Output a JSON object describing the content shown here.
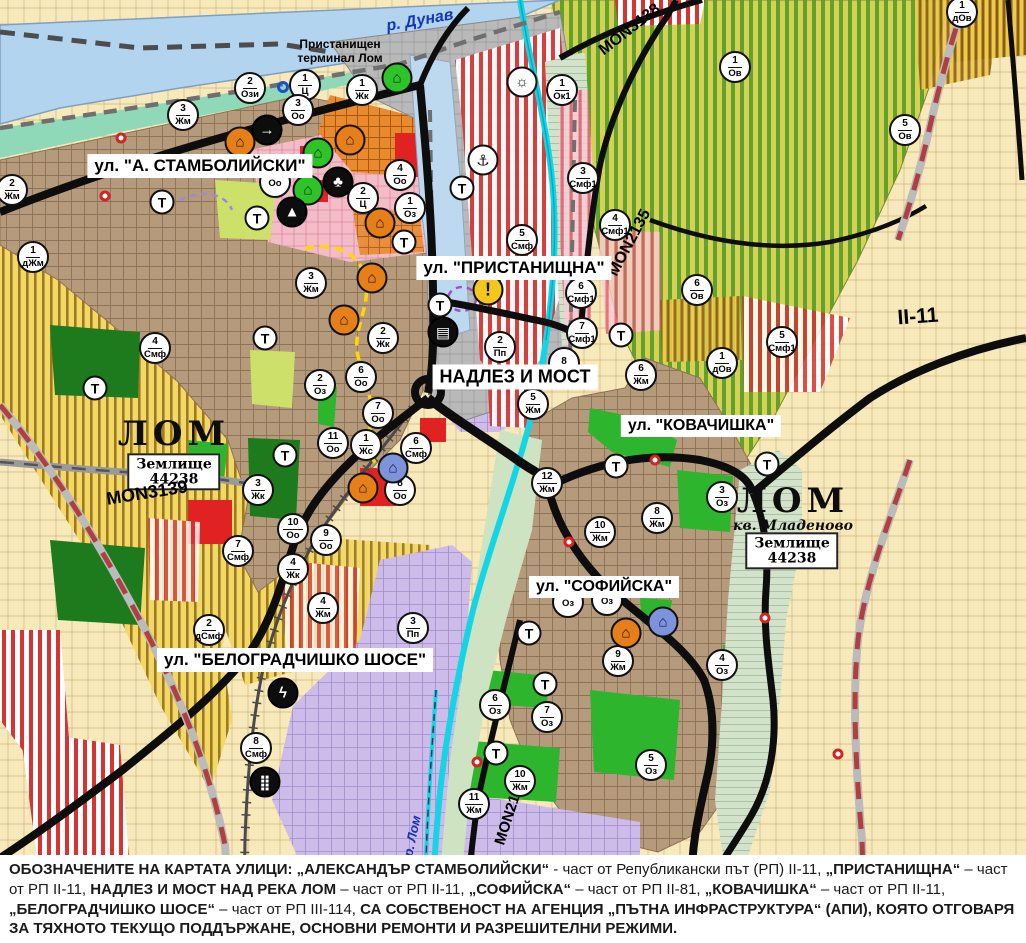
{
  "palette": {
    "water": "#b3d4ee",
    "road": "#0d0d0d",
    "river": "#12d6e6",
    "boundary_red": "#b04040",
    "field_yellow": "#f3d867",
    "orchard_green": "#5fa32c",
    "urban_brown": "#b59b7c",
    "industrial_lavender": "#cdbcea",
    "port_grey": "#b9b9b9",
    "zone_red_stripe": "#d63333"
  },
  "map": {
    "street_labels": [
      {
        "text": "ул. \"А. СТАМБОЛИЙСКИ\"",
        "x": 200,
        "y": 166,
        "fs": 17
      },
      {
        "text": "ул. \"ПРИСТАНИЩНА\"",
        "x": 514,
        "y": 268,
        "fs": 17
      },
      {
        "text": "НАДЛЕЗ И МОСТ",
        "x": 515,
        "y": 377,
        "fs": 18
      },
      {
        "text": "ул. \"КОВАЧИШКА\"",
        "x": 701,
        "y": 426,
        "fs": 16
      },
      {
        "text": "ул. \"СОФИЙСКА\"",
        "x": 604,
        "y": 587,
        "fs": 16
      },
      {
        "text": "ул. \"БЕЛОГРАДЧИШКО ШОСЕ\"",
        "x": 295,
        "y": 660,
        "fs": 17
      }
    ],
    "city_labels": [
      {
        "text": "ЛОМ",
        "x": 174,
        "y": 434
      },
      {
        "text": "ЛОМ",
        "x": 793,
        "y": 501
      }
    ],
    "suburb_label": {
      "text": "кв. Младеново",
      "x": 793,
      "y": 526
    },
    "land_unit_boxes": [
      {
        "text": "Землище\n44238",
        "x": 174,
        "y": 472
      },
      {
        "text": "Землище\n44238",
        "x": 792,
        "y": 551
      }
    ],
    "road_labels": [
      {
        "text": "MON3139",
        "x": 147,
        "y": 493,
        "rot": -9,
        "fs": 18
      },
      {
        "text": "MON3138",
        "x": 630,
        "y": 30,
        "rot": -38,
        "fs": 16
      },
      {
        "text": "MON2135",
        "x": 630,
        "y": 243,
        "rot": -62,
        "fs": 16
      },
      {
        "text": "MON2136",
        "x": 510,
        "y": 812,
        "rot": -72,
        "fs": 15
      },
      {
        "text": "II-11",
        "x": 918,
        "y": 317,
        "rot": -4,
        "fs": 21
      }
    ],
    "river_labels": [
      {
        "text": "р. Дунав",
        "x": 420,
        "y": 21,
        "rot": -10,
        "fs": 16
      },
      {
        "text": "р. Лом",
        "x": 412,
        "y": 836,
        "rot": -78,
        "fs": 13
      }
    ],
    "port_label": {
      "text": "Пристанищен\nтерминал Лом",
      "x": 340,
      "y": 52
    }
  },
  "markers": {
    "t_label": "Т",
    "zone": [
      {
        "x": 250,
        "y": 88,
        "n": "2",
        "z": "Ози"
      },
      {
        "x": 305,
        "y": 85,
        "n": "1",
        "z": "Ц"
      },
      {
        "x": 362,
        "y": 90,
        "n": "1",
        "z": "Жк"
      },
      {
        "x": 562,
        "y": 90,
        "n": "1",
        "z": "Ок1"
      },
      {
        "x": 298,
        "y": 110,
        "n": "3",
        "z": "Оо"
      },
      {
        "x": 183,
        "y": 115,
        "n": "3",
        "z": "Жм"
      },
      {
        "x": 12,
        "y": 190,
        "n": "2",
        "z": "Жм"
      },
      {
        "x": 33,
        "y": 257,
        "n": "1",
        "z": "дЖм"
      },
      {
        "x": 400,
        "y": 175,
        "n": "4",
        "z": "Оо"
      },
      {
        "x": 275,
        "y": 182,
        "n": "",
        "z": "Оо"
      },
      {
        "x": 363,
        "y": 198,
        "n": "2",
        "z": "Ц"
      },
      {
        "x": 410,
        "y": 208,
        "n": "1",
        "z": "Оз"
      },
      {
        "x": 522,
        "y": 240,
        "n": "5",
        "z": "Смф"
      },
      {
        "x": 583,
        "y": 178,
        "n": "3",
        "z": "Смф1"
      },
      {
        "x": 615,
        "y": 225,
        "n": "4",
        "z": "Смф1"
      },
      {
        "x": 581,
        "y": 293,
        "n": "6",
        "z": "Смф1"
      },
      {
        "x": 582,
        "y": 333,
        "n": "7",
        "z": "Смф1"
      },
      {
        "x": 697,
        "y": 290,
        "n": "6",
        "z": "Ов"
      },
      {
        "x": 782,
        "y": 342,
        "n": "5",
        "z": "Смф1"
      },
      {
        "x": 722,
        "y": 363,
        "n": "1",
        "z": "дОв"
      },
      {
        "x": 735,
        "y": 67,
        "n": "1",
        "z": "Ов"
      },
      {
        "x": 905,
        "y": 130,
        "n": "5",
        "z": "Ов"
      },
      {
        "x": 962,
        "y": 12,
        "n": "1",
        "z": "дОв"
      },
      {
        "x": 311,
        "y": 283,
        "n": "3",
        "z": "Жм"
      },
      {
        "x": 383,
        "y": 338,
        "n": "2",
        "z": "Жк"
      },
      {
        "x": 320,
        "y": 385,
        "n": "2",
        "z": "Оз"
      },
      {
        "x": 361,
        "y": 377,
        "n": "6",
        "z": "Оо"
      },
      {
        "x": 378,
        "y": 413,
        "n": "7",
        "z": "Оо"
      },
      {
        "x": 333,
        "y": 443,
        "n": "11",
        "z": "Оо"
      },
      {
        "x": 366,
        "y": 445,
        "n": "1",
        "z": "Жс"
      },
      {
        "x": 416,
        "y": 448,
        "n": "6",
        "z": "Смф"
      },
      {
        "x": 400,
        "y": 490,
        "n": "8",
        "z": "Оо"
      },
      {
        "x": 258,
        "y": 490,
        "n": "3",
        "z": "Жк"
      },
      {
        "x": 155,
        "y": 348,
        "n": "4",
        "z": "Смф"
      },
      {
        "x": 293,
        "y": 529,
        "n": "10",
        "z": "Оо"
      },
      {
        "x": 326,
        "y": 540,
        "n": "9",
        "z": "Оо"
      },
      {
        "x": 293,
        "y": 569,
        "n": "4",
        "z": "Жк"
      },
      {
        "x": 238,
        "y": 551,
        "n": "7",
        "z": "Смф"
      },
      {
        "x": 323,
        "y": 608,
        "n": "4",
        "z": "Жм"
      },
      {
        "x": 209,
        "y": 630,
        "n": "2",
        "z": "дСмф"
      },
      {
        "x": 413,
        "y": 628,
        "n": "3",
        "z": "Пп"
      },
      {
        "x": 256,
        "y": 748,
        "n": "8",
        "z": "Смф"
      },
      {
        "x": 500,
        "y": 347,
        "n": "2",
        "z": "Пп"
      },
      {
        "x": 564,
        "y": 363,
        "n": "8",
        "z": ""
      },
      {
        "x": 533,
        "y": 404,
        "n": "5",
        "z": "Жм"
      },
      {
        "x": 641,
        "y": 375,
        "n": "6",
        "z": "Жм"
      },
      {
        "x": 600,
        "y": 532,
        "n": "10",
        "z": "Жм"
      },
      {
        "x": 547,
        "y": 483,
        "n": "12",
        "z": "Жм"
      },
      {
        "x": 657,
        "y": 518,
        "n": "8",
        "z": "Жм"
      },
      {
        "x": 722,
        "y": 497,
        "n": "3",
        "z": "Оз"
      },
      {
        "x": 568,
        "y": 602,
        "n": "",
        "z": "Оз"
      },
      {
        "x": 607,
        "y": 600,
        "n": "",
        "z": "Оз"
      },
      {
        "x": 618,
        "y": 661,
        "n": "9",
        "z": "Жм"
      },
      {
        "x": 722,
        "y": 665,
        "n": "4",
        "z": "Оз"
      },
      {
        "x": 495,
        "y": 705,
        "n": "6",
        "z": "Оз"
      },
      {
        "x": 547,
        "y": 717,
        "n": "7",
        "z": "Оз"
      },
      {
        "x": 651,
        "y": 765,
        "n": "5",
        "z": "Оз"
      },
      {
        "x": 520,
        "y": 781,
        "n": "10",
        "z": "Жм"
      },
      {
        "x": 474,
        "y": 804,
        "n": "11",
        "z": "Жм"
      }
    ],
    "transport": [
      {
        "x": 162,
        "y": 202
      },
      {
        "x": 257,
        "y": 218
      },
      {
        "x": 265,
        "y": 338
      },
      {
        "x": 95,
        "y": 388
      },
      {
        "x": 285,
        "y": 455
      },
      {
        "x": 404,
        "y": 242
      },
      {
        "x": 440,
        "y": 305
      },
      {
        "x": 462,
        "y": 188
      },
      {
        "x": 621,
        "y": 335
      },
      {
        "x": 616,
        "y": 466
      },
      {
        "x": 529,
        "y": 633
      },
      {
        "x": 545,
        "y": 684
      },
      {
        "x": 496,
        "y": 753
      },
      {
        "x": 767,
        "y": 464
      }
    ],
    "icon_glyphs": {
      "monument": "⌂",
      "sun": "☼",
      "anchor": "⚓",
      "people": "♣",
      "peak": "▲",
      "arrow": "→",
      "truck": "▤",
      "lightning": "ϟ",
      "dots": "⣿",
      "warning": "!"
    },
    "icons": [
      {
        "x": 397,
        "y": 78,
        "type": "monument",
        "c": "green"
      },
      {
        "x": 318,
        "y": 153,
        "type": "monument",
        "c": "green"
      },
      {
        "x": 308,
        "y": 190,
        "type": "monument",
        "c": "green"
      },
      {
        "x": 240,
        "y": 142,
        "type": "monument",
        "c": "orange"
      },
      {
        "x": 350,
        "y": 140,
        "type": "monument",
        "c": "orange"
      },
      {
        "x": 380,
        "y": 223,
        "type": "monument",
        "c": "orange"
      },
      {
        "x": 372,
        "y": 278,
        "type": "monument",
        "c": "orange"
      },
      {
        "x": 344,
        "y": 320,
        "type": "monument",
        "c": "orange"
      },
      {
        "x": 363,
        "y": 488,
        "type": "monument",
        "c": "orange"
      },
      {
        "x": 626,
        "y": 633,
        "type": "monument",
        "c": "orange"
      },
      {
        "x": 393,
        "y": 468,
        "type": "monument",
        "c": "blue"
      },
      {
        "x": 663,
        "y": 622,
        "type": "monument",
        "c": "blue"
      },
      {
        "x": 267,
        "y": 130,
        "type": "arrow",
        "c": "black"
      },
      {
        "x": 338,
        "y": 182,
        "type": "people",
        "c": "black"
      },
      {
        "x": 292,
        "y": 212,
        "type": "peak",
        "c": "black"
      },
      {
        "x": 443,
        "y": 332,
        "type": "truck",
        "c": "black"
      },
      {
        "x": 283,
        "y": 693,
        "type": "lightning",
        "c": "black"
      },
      {
        "x": 265,
        "y": 782,
        "type": "dots",
        "c": "black"
      },
      {
        "x": 522,
        "y": 82,
        "type": "sun",
        "c": "white"
      },
      {
        "x": 483,
        "y": 160,
        "type": "anchor",
        "c": "white"
      },
      {
        "x": 488,
        "y": 290,
        "type": "warning",
        "c": "warn"
      }
    ],
    "red_dots": [
      {
        "x": 121,
        "y": 138
      },
      {
        "x": 105,
        "y": 196
      },
      {
        "x": 655,
        "y": 460
      },
      {
        "x": 569,
        "y": 542
      },
      {
        "x": 477,
        "y": 762
      },
      {
        "x": 765,
        "y": 618
      },
      {
        "x": 838,
        "y": 754
      }
    ],
    "blue_rings": [
      {
        "x": 283,
        "y": 87
      }
    ]
  },
  "footer": {
    "segments": [
      {
        "b": 1,
        "t": "ОБОЗНАЧЕНИТЕ НА КАРТАТА УЛИЦИ: „АЛЕКСАНДЪР СТАМБОЛИЙСКИ“"
      },
      {
        "b": 0,
        "t": " - част от Републикански път (РП) II-11, "
      },
      {
        "b": 1,
        "t": "„ПРИСТАНИЩНА“"
      },
      {
        "b": 0,
        "t": " – част от РП II-11, "
      },
      {
        "b": 1,
        "t": "НАДЛЕЗ И МОСТ НАД РЕКА ЛОМ"
      },
      {
        "b": 0,
        "t": " – част от РП II-11, "
      },
      {
        "b": 1,
        "t": "„СОФИЙСКА“"
      },
      {
        "b": 0,
        "t": " – част от РП II-81, "
      },
      {
        "b": 1,
        "t": "„КОВАЧИШКА“"
      },
      {
        "b": 0,
        "t": " – част от РП II-11, "
      },
      {
        "b": 1,
        "t": "„БЕЛОГРАДЧИШКО ШОСЕ“"
      },
      {
        "b": 0,
        "t": " – част от РП III-114, "
      },
      {
        "b": 1,
        "t": "СА СОБСТВЕНОСТ НА АГЕНЦИЯ „ПЪТНА ИНФРАСТРУКТУРА“ (АПИ), КОЯТО ОТГОВАРЯ ЗА ТЯХНОТО ТЕКУЩО ПОДДЪРЖАНЕ, ОСНОВНИ РЕМОНТИ И РАЗРЕШИТЕЛНИ РЕЖИМИ."
      }
    ]
  }
}
